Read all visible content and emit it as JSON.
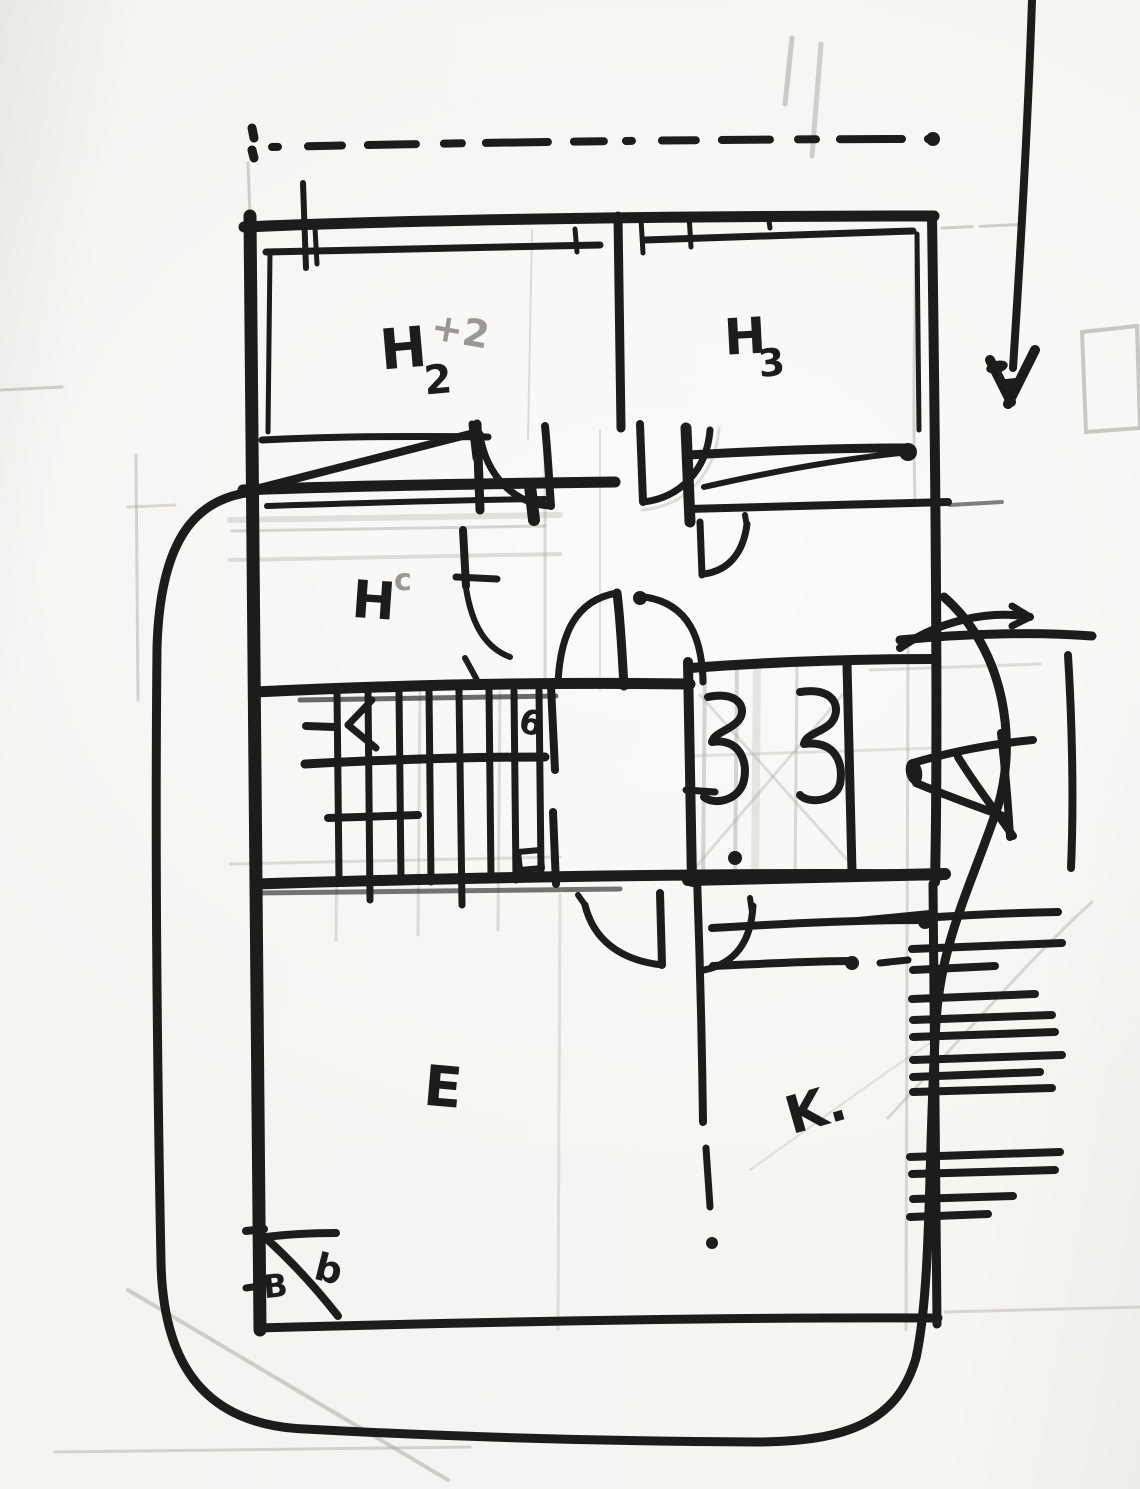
{
  "labels": {
    "room_h2_main": "H",
    "room_h2_sub": "2",
    "room_h2_note": "+2",
    "room_h3_main": "H",
    "room_h3_sub": "3",
    "room_hc_main": "H",
    "room_hc_sup": "c",
    "room_e": "E",
    "room_k": "K.",
    "stairs_note": "6",
    "corner_note_primary": "B",
    "corner_note_secondary": "b"
  },
  "colors": {
    "ink": "#1c1c1c",
    "pencil": "#a9a6a0",
    "paper": "#f4f3f0"
  }
}
